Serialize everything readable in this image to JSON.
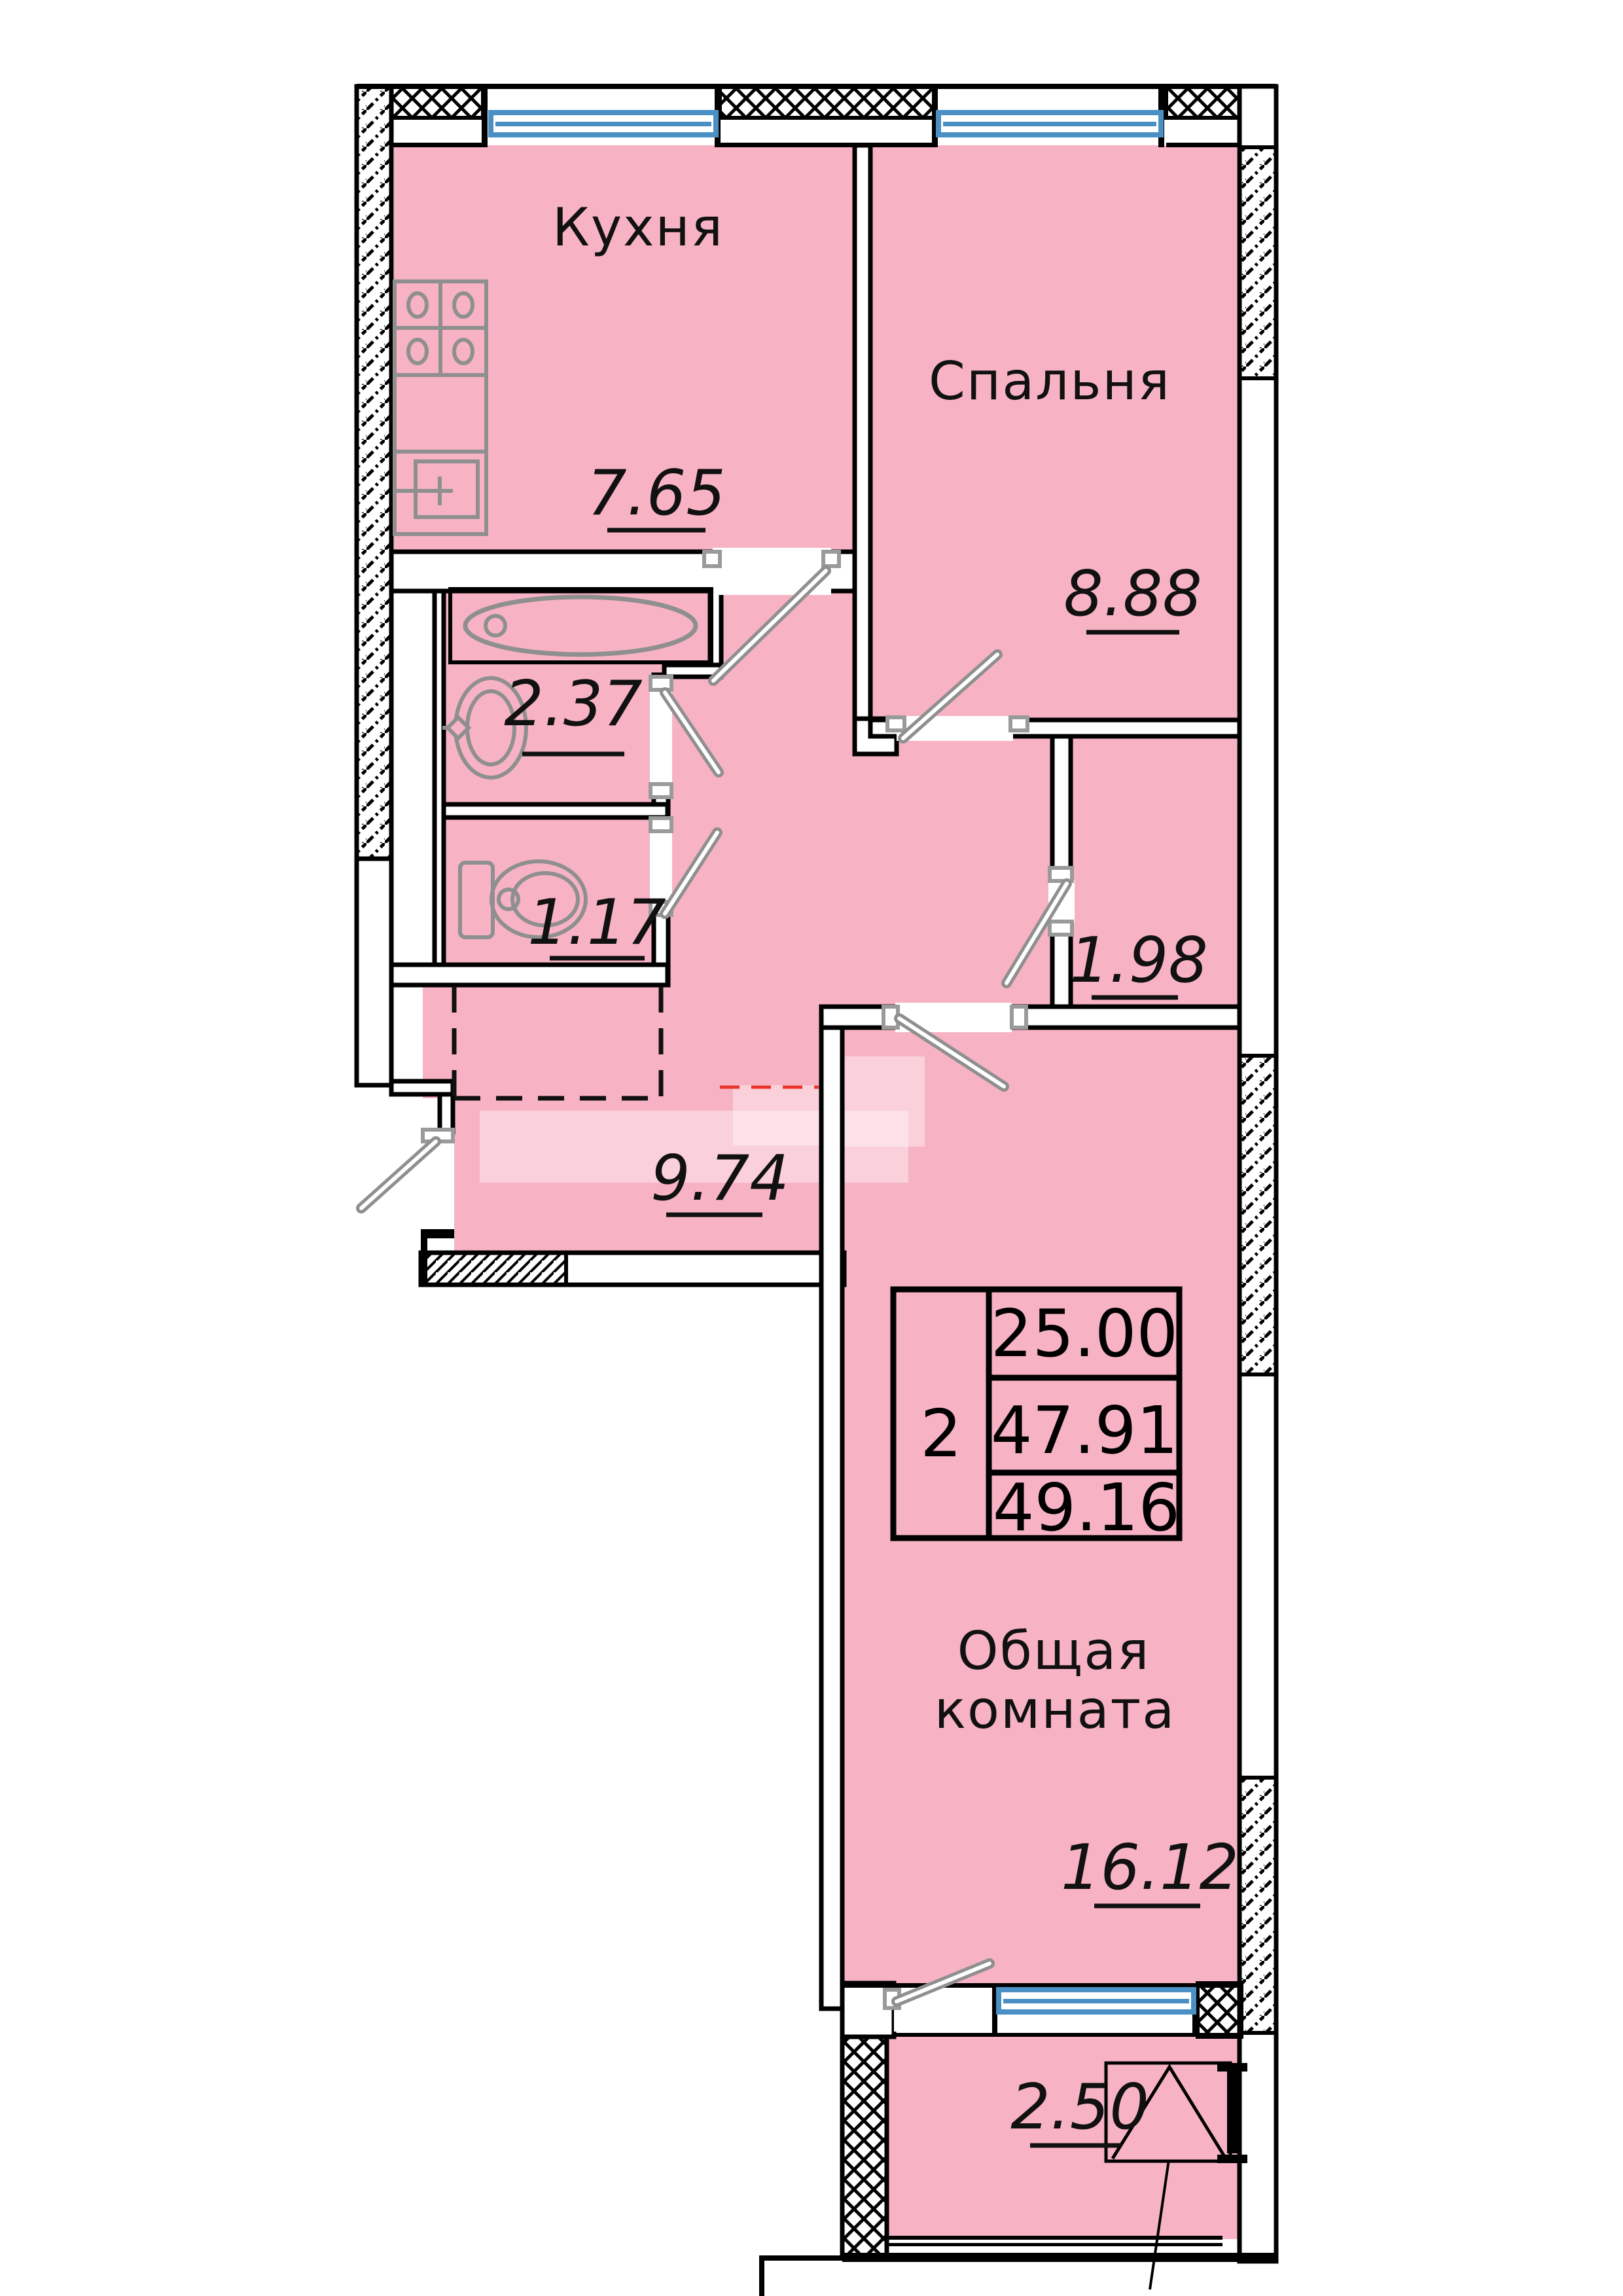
{
  "plan": {
    "title": "apartment-floor-plan",
    "rooms": [
      {
        "id": "kitchen",
        "label": "Кухня",
        "area": "7.65"
      },
      {
        "id": "bedroom",
        "label": "Спальня",
        "area": "8.88"
      },
      {
        "id": "bathroom",
        "label": "",
        "area": "2.37"
      },
      {
        "id": "toilet",
        "label": "",
        "area": "1.17"
      },
      {
        "id": "closet",
        "label": "",
        "area": "1.98"
      },
      {
        "id": "hallway",
        "label": "",
        "area": "9.74"
      },
      {
        "id": "living",
        "label_line1": "Общая",
        "label_line2": "комната",
        "area": "16.12"
      },
      {
        "id": "balcony",
        "label": "",
        "area": "2.50"
      }
    ],
    "info_box": {
      "rooms_count": "2",
      "living_area": "25.00",
      "reduced_area": "47.91",
      "total_area": "49.16"
    },
    "colors": {
      "room_fill": "#f7b3c3",
      "wall": "#000000",
      "window_frame": "#4a90c5",
      "fixture_gray": "#8f8f8f",
      "watermark_red": "#e8342c"
    }
  }
}
